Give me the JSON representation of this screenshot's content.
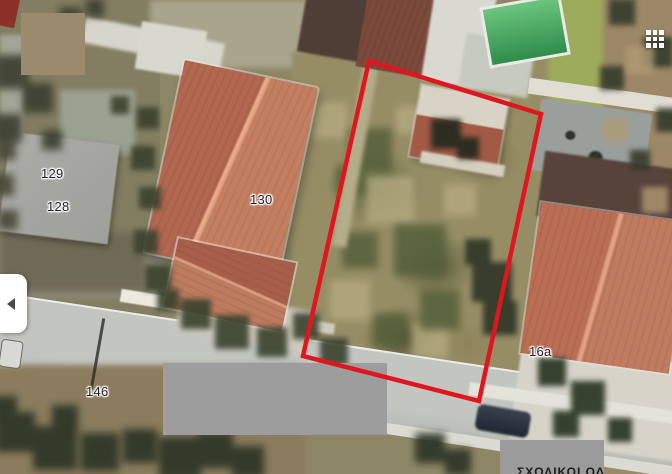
{
  "map": {
    "address_labels": [
      {
        "id": "129",
        "text": "129"
      },
      {
        "id": "128",
        "text": "128"
      },
      {
        "id": "130",
        "text": "130"
      },
      {
        "id": "146",
        "text": "146"
      },
      {
        "id": "16a",
        "text": "16a"
      }
    ],
    "bottom_clipped_text": "ΣΧΟΛΙΚΟΙ ΟΔ",
    "parcel_outline": {
      "color": "#e0161f",
      "stroke_width": 4.5,
      "points": "369,61 541,114 479,401 303,356"
    }
  },
  "redactions": {
    "top_left": {
      "color": "#9b8a6b"
    },
    "bottom_center": {
      "color": "#9d9d9d"
    },
    "bottom_right": {
      "color": "#9b9b9b"
    }
  },
  "ui": {
    "panel_toggle": {
      "icon": "chevron-left"
    },
    "apps_grid": {
      "icon": "apps-grid"
    }
  }
}
